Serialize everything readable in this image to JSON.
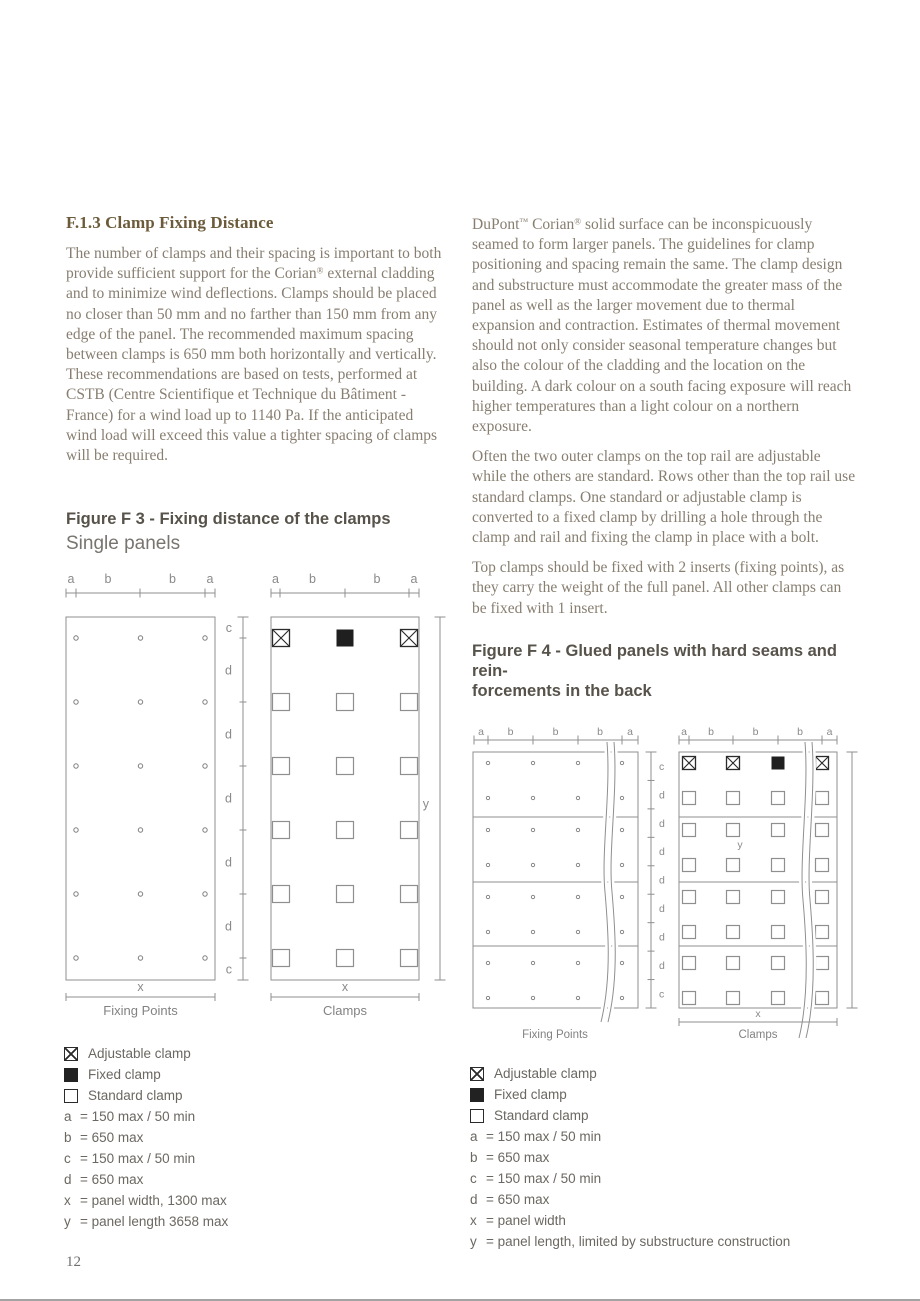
{
  "page": {
    "number": "12"
  },
  "colors": {
    "section_heading": "#6B5B3A",
    "body_text": "#877E70",
    "figure_title": "#57534B",
    "diagram_line": "#8f8f8f",
    "symbol_dark": "#2b2b2b",
    "fixed_fill": "#1f1f1f"
  },
  "left_column": {
    "heading": "F.1.3 Clamp Fixing Distance",
    "body": "The number of clamps and their spacing is important to both provide sufficient support for the Corian® external cladding and to minimize wind deflections. Clamps should be placed no closer than 50 mm and no farther than 150 mm from any edge of the panel. The recommended maximum spacing between clamps is 650 mm both horizontally and vertically. These recommendations are based on tests, performed at CSTB (Centre Scientifique et Technique du Bâtiment - France) for a wind load up to 1140 Pa. If the anticipated wind load will exceed this value a tighter spacing of clamps will be required."
  },
  "right_column": {
    "para1": "DuPont™ Corian® solid surface can be inconspicuously seamed to form larger panels. The guidelines for clamp positioning and spacing remain the same. The clamp design and substructure must accommodate the greater mass of the panel as well as the larger movement due to thermal expansion and contraction. Estimates of thermal movement should not only consider seasonal temperature changes but also the colour of the cladding and the location on the building. A dark colour on a south facing exposure will reach higher temperatures than a light colour on a northern exposure.",
    "para2": "Often the two outer clamps on the top rail are adjustable while the others are standard. Rows other than the top rail use standard clamps. One standard or adjustable clamp is converted to a fixed clamp by drilling a hole through the clamp and rail and fixing the clamp in place with a bolt.",
    "para3": "Top clamps should be fixed with 2 inserts (fixing points), as they carry the weight of the full panel. All other clamps can be fixed with 1 insert."
  },
  "figure3": {
    "title": "Figure F 3 - Fixing distance of the clamps",
    "subtitle": "Single panels",
    "diagram": {
      "top_labels": [
        "a",
        "b",
        "b",
        "a"
      ],
      "side_labels": [
        "c",
        "d",
        "d",
        "d",
        "d",
        "d",
        "c"
      ],
      "x_label": "x",
      "y_label": "y",
      "left_caption": "Fixing Points",
      "right_caption": "Clamps",
      "rows": 6,
      "cols": 3,
      "top_row_clamps": [
        "adjustable",
        "fixed",
        "adjustable"
      ]
    }
  },
  "figure4": {
    "title_line1": "Figure F 4 - Glued panels with hard seams and rein-",
    "title_line2": "forcements in the back",
    "diagram": {
      "top_labels": [
        "a",
        "b",
        "b",
        "b",
        "a"
      ],
      "side_labels": [
        "c",
        "d",
        "d",
        "d",
        "d",
        "d",
        "d",
        "d",
        "c"
      ],
      "x_label": "x",
      "y_label": "y",
      "left_caption": "Fixing Points",
      "right_caption": "Clamps",
      "rows": 8,
      "cols": 4,
      "sections": 4,
      "top_row_clamps": [
        "adjustable",
        "adjustable",
        "fixed",
        "adjustable"
      ]
    }
  },
  "legend3": {
    "symbols": [
      {
        "type": "adjustable",
        "label": "Adjustable clamp"
      },
      {
        "type": "fixed",
        "label": "Fixed clamp"
      },
      {
        "type": "standard",
        "label": "Standard clamp"
      }
    ],
    "definitions": [
      {
        "key": "a",
        "value": "= 150 max / 50 min"
      },
      {
        "key": "b",
        "value": "= 650 max"
      },
      {
        "key": "c",
        "value": "= 150 max / 50 min"
      },
      {
        "key": "d",
        "value": "= 650 max"
      },
      {
        "key": "x",
        "value": "= panel width, 1300 max"
      },
      {
        "key": "y",
        "value": "= panel length 3658 max"
      }
    ]
  },
  "legend4": {
    "symbols": [
      {
        "type": "adjustable",
        "label": "Adjustable clamp"
      },
      {
        "type": "fixed",
        "label": "Fixed clamp"
      },
      {
        "type": "standard",
        "label": "Standard clamp"
      }
    ],
    "definitions": [
      {
        "key": "a",
        "value": "= 150 max / 50 min"
      },
      {
        "key": "b",
        "value": "= 650 max"
      },
      {
        "key": "c",
        "value": "= 150 max / 50 min"
      },
      {
        "key": "d",
        "value": "= 650 max"
      },
      {
        "key": "x",
        "value": "= panel width"
      },
      {
        "key": "y",
        "value": "= panel length, limited by substructure construction"
      }
    ]
  }
}
